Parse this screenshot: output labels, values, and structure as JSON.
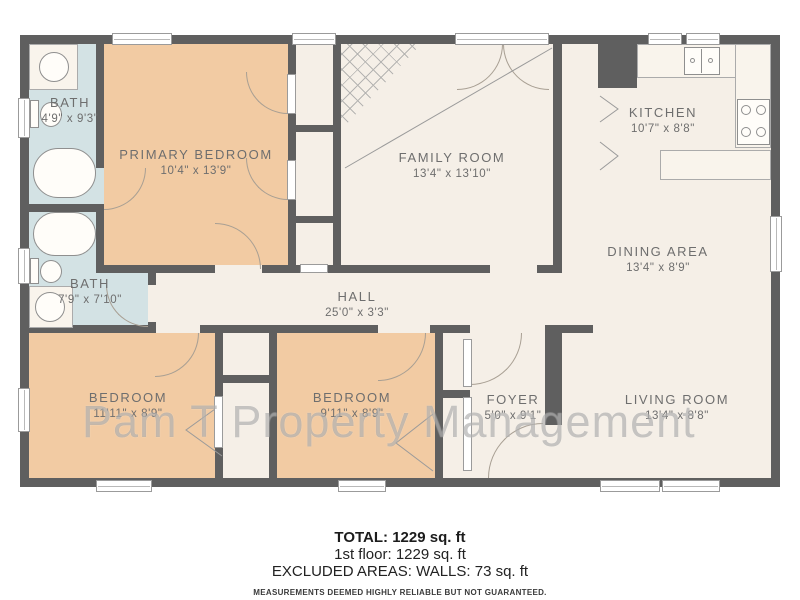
{
  "watermark": "Pam T Property Management",
  "colors": {
    "wall": "#5f5f5f",
    "bath_floor": "#d3e2e4",
    "bedroom_floor": "#f2cba3",
    "common_floor": "#f5efe7",
    "label_text": "#6e6e6e"
  },
  "rooms": [
    {
      "id": "bath-1",
      "name": "BATH",
      "dims": "4'9\" x 9'3\""
    },
    {
      "id": "primary-bedroom",
      "name": "PRIMARY BEDROOM",
      "dims": "10'4\" x 13'9\""
    },
    {
      "id": "family-room",
      "name": "FAMILY ROOM",
      "dims": "13'4\" x 13'10\""
    },
    {
      "id": "kitchen",
      "name": "KITCHEN",
      "dims": "10'7\" x 8'8\""
    },
    {
      "id": "dining-area",
      "name": "DINING AREA",
      "dims": "13'4\" x 8'9\""
    },
    {
      "id": "bath-2",
      "name": "BATH",
      "dims": "7'9\" x 7'10\""
    },
    {
      "id": "hall",
      "name": "HALL",
      "dims": "25'0\" x 3'3\""
    },
    {
      "id": "bedroom-left",
      "name": "BEDROOM",
      "dims": "11'11\" x 8'9\""
    },
    {
      "id": "bedroom-middle",
      "name": "BEDROOM",
      "dims": "9'11\" x 8'9\""
    },
    {
      "id": "foyer",
      "name": "FOYER",
      "dims": "5'0\" x 9'1\""
    },
    {
      "id": "living-room",
      "name": "LIVING ROOM",
      "dims": "13'4\" x 8'8\""
    }
  ],
  "footer": {
    "total": "TOTAL: 1229 sq. ft",
    "floor1": "1st floor: 1229 sq. ft",
    "excluded": "EXCLUDED AREAS: WALLS: 73 sq. ft",
    "disclaimer": "MEASUREMENTS DEEMED HIGHLY RELIABLE BUT NOT GUARANTEED."
  }
}
